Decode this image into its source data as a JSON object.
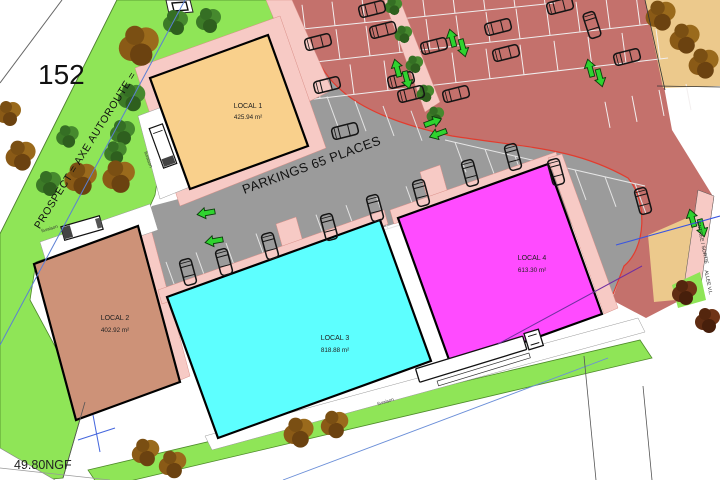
{
  "page": {
    "width": 720,
    "height": 480
  },
  "labels": {
    "parcel_number": "152",
    "road_axis": "PROSPECT = AXE AUTOROUTE =",
    "parking": "PARKINGS 65 PLACES",
    "elevation": "49.80NGF",
    "entry_exit": "ENTREE / SORTIE",
    "lane": "ALLEE V.L.",
    "delivery": "livraison"
  },
  "buildings": [
    {
      "name": "LOCAL 1",
      "area": "425.94 m²",
      "color": "#f9d08c"
    },
    {
      "name": "LOCAL 2",
      "area": "402.92 m²",
      "color": "#cd9278"
    },
    {
      "name": "LOCAL 3",
      "area": "818.88 m²",
      "color": "#5dffff"
    },
    {
      "name": "LOCAL 4",
      "area": "613.30 m²",
      "color": "#ff4bff"
    }
  ],
  "colors": {
    "grass": "#8fe557",
    "parking_red": "#c4716c",
    "parking_gray": "#9b9b9b",
    "sidewalk_pink": "#f7cac5",
    "sand_tan": "#ecc98c",
    "accent_curve": "#e23c2e",
    "axis_blue": "#5b7fd4",
    "survey_purple": "#7030a0",
    "arrow_green": "#2fd32f"
  },
  "decor": {
    "trees": [
      {
        "t": "g",
        "x": 175,
        "y": 22,
        "s": 1
      },
      {
        "t": "g",
        "x": 208,
        "y": 20,
        "s": 1
      },
      {
        "t": "g",
        "x": 131,
        "y": 97,
        "s": 1.1
      },
      {
        "t": "g",
        "x": 122,
        "y": 132,
        "s": 1
      },
      {
        "t": "g",
        "x": 115,
        "y": 152,
        "s": 0.9
      },
      {
        "t": "g",
        "x": 48,
        "y": 183,
        "s": 1
      },
      {
        "t": "g",
        "x": 67,
        "y": 136,
        "s": 0.9
      },
      {
        "t": "b",
        "x": 138,
        "y": 45,
        "s": 1.6
      },
      {
        "t": "b",
        "x": 80,
        "y": 178,
        "s": 1.3
      },
      {
        "t": "b",
        "x": 118,
        "y": 176,
        "s": 1.3
      },
      {
        "t": "b",
        "x": 20,
        "y": 155,
        "s": 1.2
      },
      {
        "t": "b",
        "x": 8,
        "y": 113,
        "s": 1
      },
      {
        "t": "g",
        "x": 393,
        "y": 6,
        "s": 0.7
      },
      {
        "t": "g",
        "x": 403,
        "y": 34,
        "s": 0.7
      },
      {
        "t": "g",
        "x": 414,
        "y": 64,
        "s": 0.7
      },
      {
        "t": "g",
        "x": 425,
        "y": 93,
        "s": 0.7
      },
      {
        "t": "g",
        "x": 435,
        "y": 115,
        "s": 0.7
      },
      {
        "t": "b",
        "x": 145,
        "y": 452,
        "s": 1.1
      },
      {
        "t": "b",
        "x": 172,
        "y": 464,
        "s": 1.1
      },
      {
        "t": "b",
        "x": 298,
        "y": 432,
        "s": 1.2
      },
      {
        "t": "b",
        "x": 334,
        "y": 424,
        "s": 1.1
      },
      {
        "t": "b",
        "x": 660,
        "y": 15,
        "s": 1.2
      },
      {
        "t": "b",
        "x": 684,
        "y": 38,
        "s": 1.2
      },
      {
        "t": "b",
        "x": 703,
        "y": 63,
        "s": 1.2
      },
      {
        "t": "m",
        "x": 684,
        "y": 292,
        "s": 1
      },
      {
        "t": "m",
        "x": 707,
        "y": 320,
        "s": 1
      }
    ],
    "cars": [
      {
        "x": 318,
        "y": 42,
        "r": -14
      },
      {
        "x": 372,
        "y": 9,
        "r": -14
      },
      {
        "x": 383,
        "y": 30,
        "r": -14
      },
      {
        "x": 434,
        "y": 46,
        "r": -14
      },
      {
        "x": 498,
        "y": 27,
        "r": -14
      },
      {
        "x": 506,
        "y": 53,
        "r": -14
      },
      {
        "x": 401,
        "y": 80,
        "r": -14
      },
      {
        "x": 411,
        "y": 94,
        "r": -14
      },
      {
        "x": 456,
        "y": 94,
        "r": -14
      },
      {
        "x": 560,
        "y": 6,
        "r": -14
      },
      {
        "x": 627,
        "y": 57,
        "r": -14
      },
      {
        "x": 592,
        "y": 25,
        "r": 72
      },
      {
        "x": 327,
        "y": 85,
        "r": -14
      },
      {
        "x": 345,
        "y": 131,
        "r": -14
      },
      {
        "x": 188,
        "y": 272,
        "r": 75
      },
      {
        "x": 224,
        "y": 262,
        "r": 75
      },
      {
        "x": 270,
        "y": 246,
        "r": 75
      },
      {
        "x": 329,
        "y": 227,
        "r": 75
      },
      {
        "x": 375,
        "y": 208,
        "r": 75
      },
      {
        "x": 421,
        "y": 193,
        "r": 75
      },
      {
        "x": 470,
        "y": 173,
        "r": 75
      },
      {
        "x": 513,
        "y": 157,
        "r": 75
      },
      {
        "x": 556,
        "y": 172,
        "r": 75
      },
      {
        "x": 643,
        "y": 201,
        "r": 75
      }
    ],
    "arrows": [
      {
        "x": 206,
        "y": 213,
        "r": -100
      },
      {
        "x": 214,
        "y": 241,
        "r": -100
      },
      {
        "x": 397,
        "y": 68,
        "r": -15
      },
      {
        "x": 407,
        "y": 80,
        "r": 165
      },
      {
        "x": 452,
        "y": 38,
        "r": -15
      },
      {
        "x": 463,
        "y": 48,
        "r": 165
      },
      {
        "x": 590,
        "y": 68,
        "r": -15
      },
      {
        "x": 600,
        "y": 78,
        "r": 165
      },
      {
        "x": 433,
        "y": 122,
        "r": 70
      },
      {
        "x": 438,
        "y": 134,
        "r": -110
      },
      {
        "x": 692,
        "y": 218,
        "r": -15
      },
      {
        "x": 702,
        "y": 228,
        "r": 165
      }
    ],
    "stall_rows": [
      {
        "x": 305,
        "y": 28.8,
        "m": -0.103,
        "step": 30,
        "n": 9,
        "dx": -3,
        "dy": -24,
        "c": "#f3efef"
      },
      {
        "x": 310,
        "y": 62.6,
        "m": -0.114,
        "step": 30,
        "n": 12,
        "dx": -4,
        "dy": -30,
        "c": "#f3efef"
      },
      {
        "x": 320,
        "y": 98.4,
        "m": -0.116,
        "step": 34,
        "n": 11,
        "dx": -4,
        "dy": -30,
        "c": "#f3efef"
      },
      {
        "x": 610,
        "y": 127.8,
        "m": -0.22,
        "step": 27,
        "n": 4,
        "dx": -5,
        "dy": -26,
        "c": "#f3efef"
      },
      {
        "x": 178,
        "y": 294.9,
        "m": -0.315,
        "step": 30,
        "n": 9,
        "dx": -12,
        "dy": -33,
        "c": "#e3e3e3"
      },
      {
        "x": 455,
        "y": 142.3,
        "m": 0.23,
        "step": 30,
        "n": 7,
        "dx": 11,
        "dy": 30,
        "c": "#e3e3e3"
      },
      {
        "x": 310,
        "y": 121.7,
        "m": 0.17,
        "step": 28,
        "n": 5,
        "dx": -11,
        "dy": -30,
        "c": "#e3e3e3"
      }
    ]
  }
}
